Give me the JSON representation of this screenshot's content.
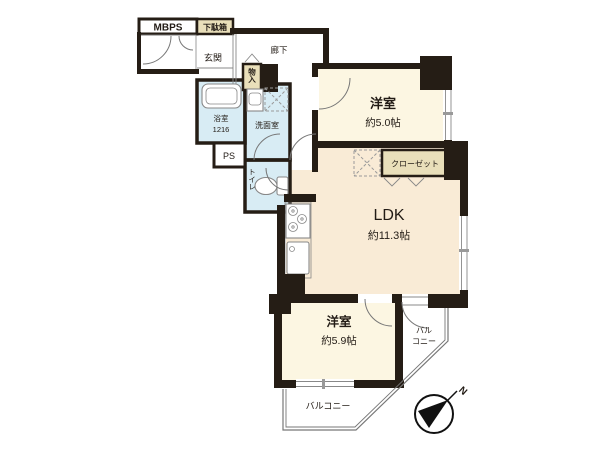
{
  "floorplan": {
    "labels": {
      "mbps": "MBPS",
      "shoe_cabinet": "下駄箱",
      "entrance": "玄関",
      "hallway": "廊下",
      "storage": "物入",
      "bathroom_name": "浴室",
      "bathroom_size": "1216",
      "washroom": "洗面室",
      "pipe_space": "PS",
      "toilet": "トイレ",
      "bedroom1_name": "洋室",
      "bedroom1_size": "約5.0帖",
      "closet": "クローゼット",
      "ldk_name": "LDK",
      "ldk_size": "約11.3帖",
      "bedroom2_name": "洋室",
      "bedroom2_size": "約5.9帖",
      "balcony_side_line1": "バル",
      "balcony_side_line2": "コニー",
      "balcony_bottom": "バルコニー",
      "compass_north": "N"
    },
    "colors": {
      "wall": "#251d15",
      "bedroom_fill": "#fcf6e2",
      "ldk_fill": "#f9ebd6",
      "wet_fill": "#d8ecf4",
      "tan_fill": "#e9dfba",
      "line": "#888888",
      "ink": "#221b15",
      "background": "#ffffff"
    }
  }
}
